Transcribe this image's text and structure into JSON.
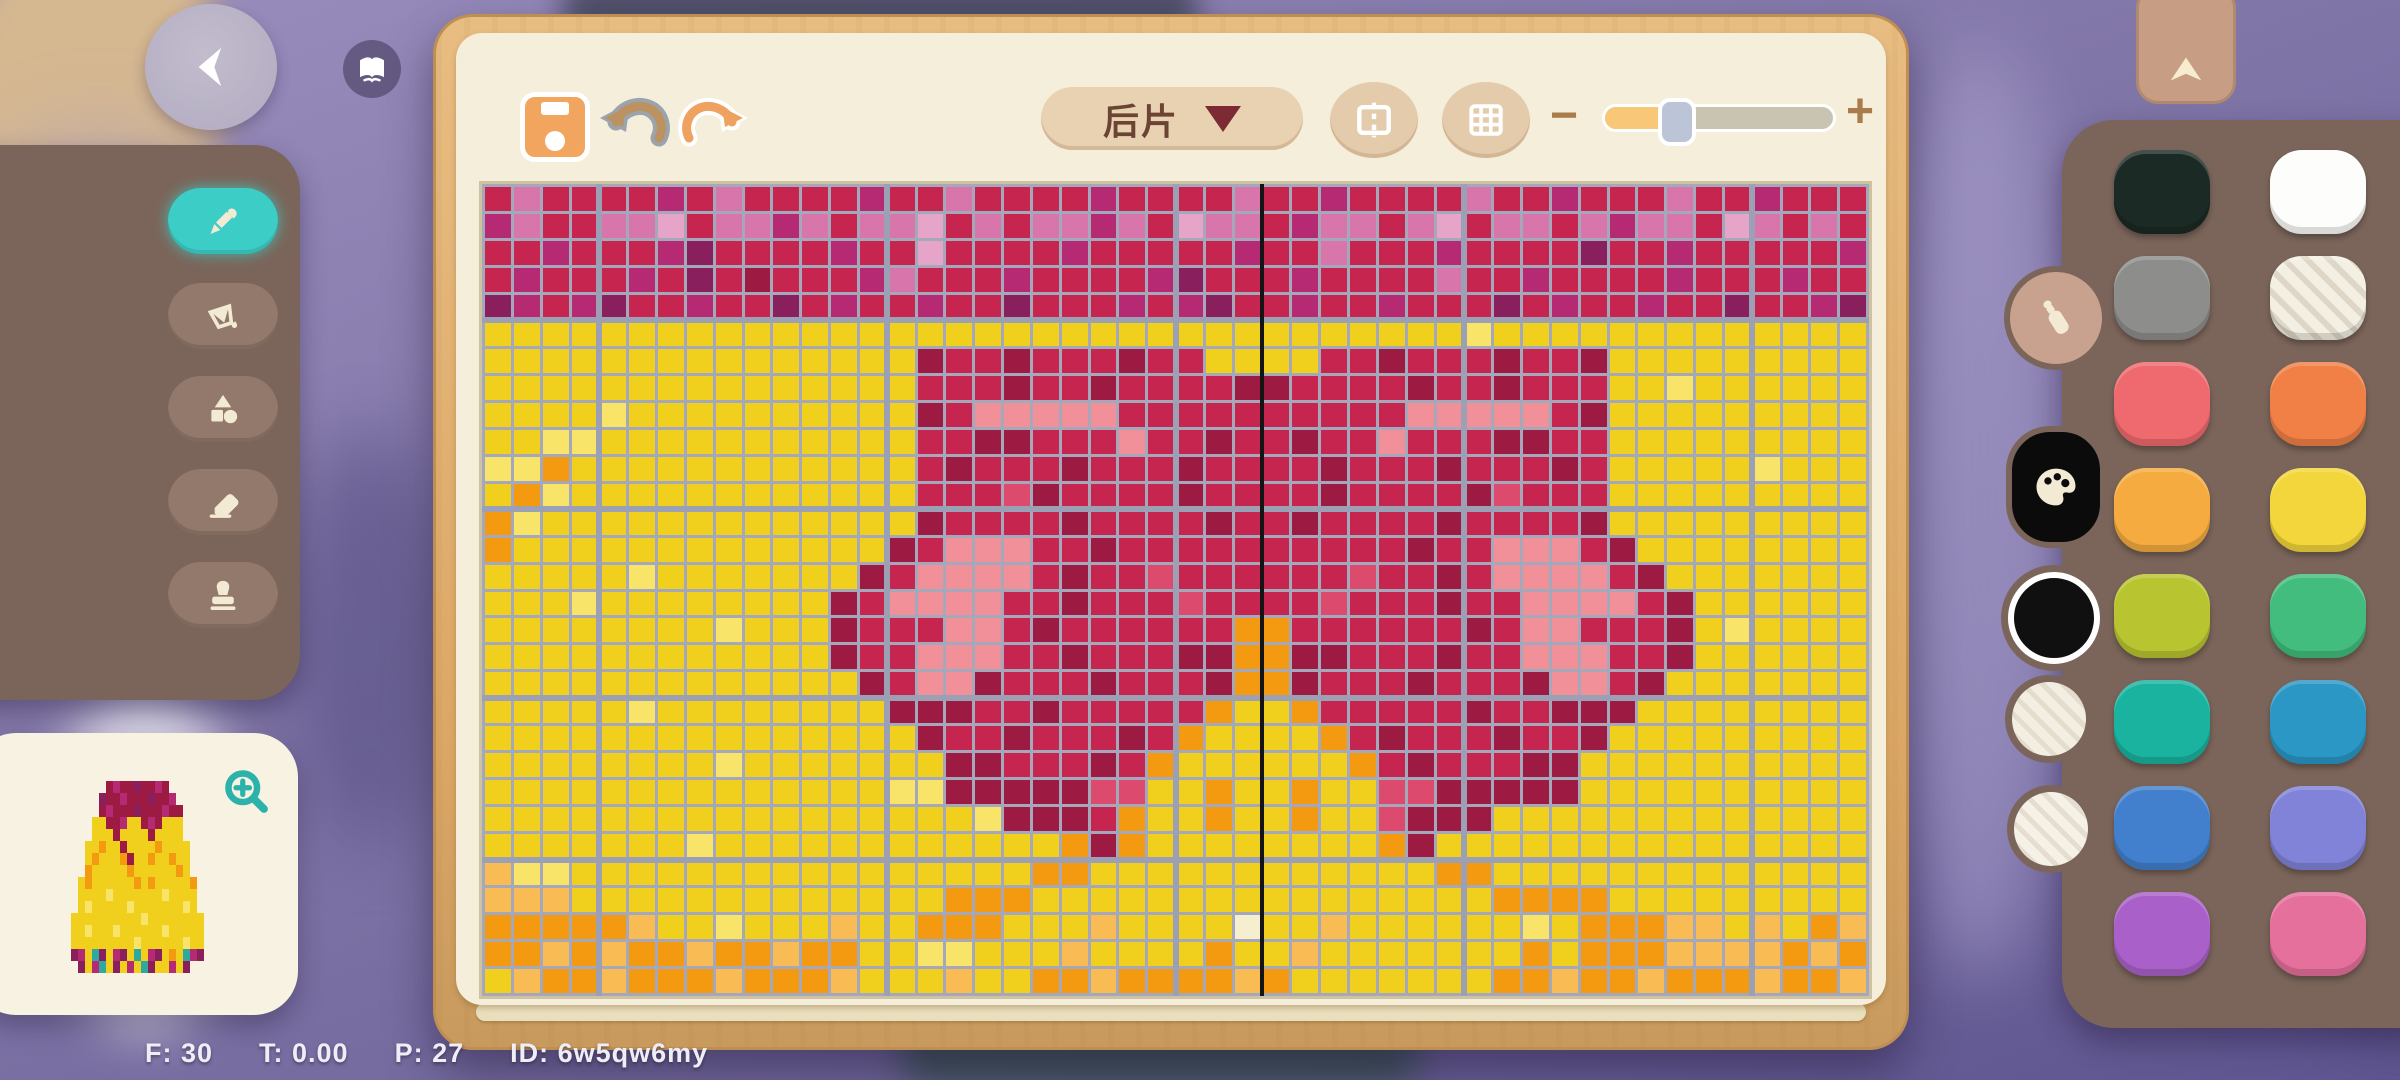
{
  "status_bar": {
    "items": [
      "F: 30",
      "T: 0.00",
      "P: 27",
      "ID: 6w5qw6my"
    ]
  },
  "toolbar": {
    "piece_selector_label": "后片",
    "zoom_out_label": "−",
    "zoom_in_label": "+",
    "zoom_fraction": 0.27
  },
  "tools": {
    "items": [
      {
        "id": "pencil",
        "active": true
      },
      {
        "id": "fill-bucket",
        "active": false
      },
      {
        "id": "shapes",
        "active": false
      },
      {
        "id": "eraser",
        "active": false
      },
      {
        "id": "stamp",
        "active": false
      }
    ]
  },
  "colors": {
    "panel": "#7b655a",
    "current_color": "#101010",
    "recent_colors": [
      "#f2eee1",
      "#f5f1e6"
    ],
    "swatch_rows": [
      [
        {
          "name": "black",
          "hex": "#1b2a24"
        },
        {
          "name": "white",
          "hex": "#fdfdfb"
        }
      ],
      [
        {
          "name": "gray",
          "hex": "#8d8d8b"
        },
        {
          "name": "linen",
          "hex": "#f3efe3",
          "striped": true
        }
      ],
      [
        {
          "name": "coral",
          "hex": "#ef6a6e"
        },
        {
          "name": "orange",
          "hex": "#f08046"
        }
      ],
      [
        {
          "name": "amber",
          "hex": "#f5ab3f"
        },
        {
          "name": "yellow",
          "hex": "#f3d63b"
        }
      ],
      [
        {
          "name": "lime",
          "hex": "#b8c531"
        },
        {
          "name": "green",
          "hex": "#42bd7d"
        }
      ],
      [
        {
          "name": "teal",
          "hex": "#1ab3a0"
        },
        {
          "name": "cyan",
          "hex": "#2b97c5"
        }
      ],
      [
        {
          "name": "blue",
          "hex": "#4280cd"
        },
        {
          "name": "periwinkle",
          "hex": "#8183d8"
        }
      ],
      [
        {
          "name": "purple",
          "hex": "#a961c9"
        },
        {
          "name": "pink",
          "hex": "#e5709b"
        }
      ]
    ]
  },
  "canvas": {
    "cols": 48,
    "rows": 30,
    "seam_col": 27,
    "thick_cols": [
      3,
      13,
      23,
      33,
      43
    ],
    "thick_rows": [
      4,
      11,
      18,
      24
    ],
    "gridline": "#a4a8ba",
    "seam": "#141414",
    "palette": {
      "Y": "#f0cf1d",
      "L": "#f7e468",
      "O": "#f49a10",
      "o": "#f9bc55",
      "C": "#c62550",
      "D": "#9d1a42",
      "R": "#dc4a6e",
      "P": "#f2909a",
      "M": "#b52a72",
      "U": "#8a1f5e",
      "K": "#d876ac",
      "k": "#e6a4c8",
      "W": "#f6efcf"
    },
    "rows_data": [
      [
        "CKCCCCMCKCCC",
        "CMCCKCCCCMCC",
        "CCKCCMCCCCKC",
        "CMCCCKCCMCCC"
      ],
      [
        "MKCCKKkCKKMK",
        "CKKkCKCKKMKC",
        "kKKCMKKCKkCK",
        "KCKMKKCkKCKC"
      ],
      [
        "CCMCCCMUCCCC",
        "MCCkCCCCMCCC",
        "CCMCCKCCCMCC",
        "CCUCCMCCCCCM"
      ],
      [
        "CMCCCMCUCDCC",
        "CMKCCCMCCCCM",
        "UCCCMCCCCKCC",
        "MCCCCMCCCMCC"
      ],
      [
        "UMCMUCCMCCUC",
        "MCCMCCUCCCMC",
        "MUCCMCCMCCCU",
        "CMCCMCCUCCMU"
      ],
      [
        "YYYYYYYYYYYY",
        "YYYYYYYYYYYY",
        "YYYYYYYYYYLY",
        "YYYYYYYYYYYY"
      ],
      [
        "YYYYYYYYYYYY",
        "YYYDCCDCCCDC",
        "CYYYYCCDCCCD",
        "CCDYYYYYYYYY"
      ],
      [
        "YYYYYYYYYYYY",
        "YYYCCCDCCDCC",
        "CCDDCCCCDCCD",
        "CCCYYLYYYYYY"
      ],
      [
        "YYYYLYYYYYYY",
        "YYYDCPPPPPCC",
        "CCCCCCCCPPPP",
        "PCDYYYYYYYYY"
      ],
      [
        "YYLLYYYYYYYY",
        "YYYCCDDCCCPC",
        "CDCCDCCPCCCD",
        "DCCYYYYYYYYY"
      ],
      [
        "LLOYYYYYYYYY",
        "YYYCDCCCDCCC",
        "DCCCCDCCCDCC",
        "CDCYYYYYLYYY"
      ],
      [
        "YOLYYYYYYYYY",
        "YYYCCCRDCCCC",
        "DCCCCDCCCCDR",
        "CCCYYYYYYYYY"
      ],
      [
        "OLYYYYYYYYYY",
        "YYYDCCCCDCCC",
        "CDCCDCCCCDCC",
        "CCDYYYYYYYYY"
      ],
      [
        "OYYYYYYYYYYY",
        "YYDCPPPCCDCC",
        "CCCCCCCCDCCP",
        "PPCDYYYYYYYY"
      ],
      [
        "YYYYYLYYYYYY",
        "YDCPPPPCDCCR",
        "CCCCCCRCCDCP",
        "PPPCDYYYYYYY"
      ],
      [
        "YYYLYYYYYYYY",
        "DCPPPPCCDCCC",
        "RCCCCRCCCDCC",
        "PPPPCDYYYYYY"
      ],
      [
        "YYYYYYYYLYYY",
        "DCCCPPCDCCCC",
        "CCOOCCCCCCDC",
        "PPCCCDYLYYYY"
      ],
      [
        "YYYYYYYYYYYY",
        "DCCPPPCCDCCC",
        "DDOODDCCCDCC",
        "PPPCCDYYYYYY"
      ],
      [
        "YYYYYYYYYYYY",
        "YDCPPDCCCDCC",
        "CDOODCCCDCCC",
        "DPPCDYYYYYYY"
      ],
      [
        "YYYYYLYYYYYY",
        "YYDDDCCDCCCC",
        "COYYOCCCCCDC",
        "CDDDYYYYYYYY"
      ],
      [
        "YYYYYYYYYYYY",
        "YYYDCCDCCCDC",
        "OYYYYOCDCCCD",
        "CCDYYYYYYYYY"
      ],
      [
        "YYYYYYYYLYYY",
        "YYYYDDCCCDCO",
        "YYYYYYOCDCCC",
        "DDYYYYYYYYYY"
      ],
      [
        "YYYYYYYYYYYY",
        "YYLLDDDDDRRY",
        "YOYYOYYRRDDD",
        "DDYYYYYYYYYY"
      ],
      [
        "YYYYYYYYYYYY",
        "YYYYYLDDDCOY",
        "YOYYOYYRDDDY",
        "YYYYYYYYYYYY"
      ],
      [
        "YYYYYYYLYYYY",
        "YYYYYYYYODOY",
        "YYYYYYYODYYY",
        "YYYYYYYYYYYY"
      ],
      [
        "oLLYYYYYYYYY",
        "YYYYYYYOOYYY",
        "YYYYYYYYYOOY",
        "YYYYYYYYYYYY"
      ],
      [
        "oooYYYYYYYYY",
        "YYYYOOOYYYYY",
        "YYYYYYYYYYYO",
        "OOOYYYYYYYYY"
      ],
      [
        "OOOOOoYYLYYY",
        "oYYOOOYYYoYY",
        "YYWYYoYYYYYY",
        "LYOOOooYoYOo"
      ],
      [
        "OOoOoOOoOOoO",
        "OYYLLYYYoYYY",
        "YOYYoYYYYYYY",
        "OYOOOooooOoO"
      ],
      [
        "YoOOoOOOoOOO",
        "oYYYoYYOOoOO",
        "OOoOYYYYYYYO",
        "OoOOoOOOoOOo"
      ]
    ]
  },
  "preview": {
    "cols": 22,
    "rows": 16,
    "palette_extra": {
      "T": "#2fa8a0"
    },
    "rows_data": [
      "......DMDDUDDMD.......",
      ".....UDDMDDDUDDM......",
      ".....DMDDDUDDDMDD.....",
      "....YYDDMYYDMDYYY.....",
      "....YYYDYYYYDYYYY.....",
      "...YYOYYDYYYYOYYYY....",
      "...YOYYYODYYOYYOYY....",
      "...OYYYYYOYYYYYYOY....",
      "..YOYYYYYYOYOYYYYYO...",
      "..YYYYLYYYYYYYLYYYY...",
      "..YLYYYYYLYYYYYYYLY...",
      ".YYYYYYYYYYLYYYYYYYY..",
      ".YYLYYYLYYYYYYLYYYYY..",
      ".YYYYYYYYYLYYYYYYLYY..",
      ".UMYTUYMUYTYMUYOYTMU..",
      "..UYMTYUYMYTUYYMYU...."
    ]
  }
}
